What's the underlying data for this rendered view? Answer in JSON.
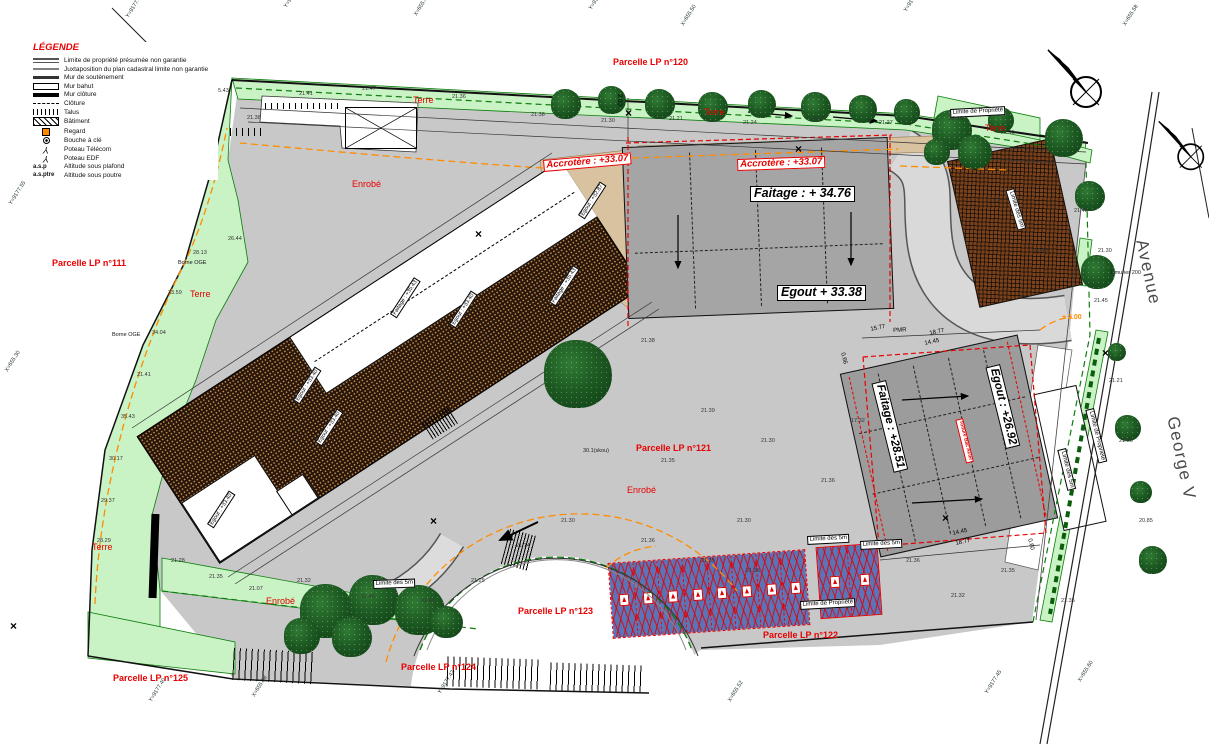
{
  "legend": {
    "title": "LÉGENDE",
    "items": [
      {
        "sym": "lim-prop",
        "label": "Limite de propriété présumée non garantie"
      },
      {
        "sym": "juxta",
        "label": "Juxtaposition du plan cadastral limite non garantie"
      },
      {
        "sym": "mur-sout",
        "label": "Mur de soutènement"
      },
      {
        "sym": "mur-bahut",
        "label": "Mur bahut"
      },
      {
        "sym": "mur-cloture",
        "label": "Mur clôture"
      },
      {
        "sym": "cloture",
        "label": "Clôture"
      },
      {
        "sym": "talus",
        "label": "Talus"
      },
      {
        "sym": "batiment",
        "label": "Bâtiment"
      },
      {
        "sym": "regard",
        "label": "Regard"
      },
      {
        "sym": "bouche",
        "label": "Bouche à clé"
      },
      {
        "sym": "poteau",
        "label": "Poteau Télécom"
      },
      {
        "sym": "poteau",
        "label": "Poteau EDF"
      },
      {
        "key": "a.s.p",
        "label": "Altitude sous plafond"
      },
      {
        "key": "a.s.ptre",
        "label": "Altitude sous poutre"
      }
    ]
  },
  "labels": {
    "parcels": {
      "cls": "parcel",
      "items": [
        {
          "t": "Parcelle LP n°120",
          "x": 613,
          "y": 58
        },
        {
          "t": "Parcelle LP n°111",
          "x": 52,
          "y": 259
        },
        {
          "t": "Parcelle LP n°121",
          "x": 636,
          "y": 444
        },
        {
          "t": "Parcelle LP n°122",
          "x": 763,
          "y": 631
        },
        {
          "t": "Parcelle LP n°123",
          "x": 518,
          "y": 607
        },
        {
          "t": "Parcelle LP n°124",
          "x": 401,
          "y": 663
        },
        {
          "t": "Parcelle LP n°125",
          "x": 113,
          "y": 674
        }
      ]
    },
    "terre": {
      "cls": "terre",
      "items": [
        {
          "t": "Terre",
          "x": 413,
          "y": 96
        },
        {
          "t": "Terre",
          "x": 704,
          "y": 108
        },
        {
          "t": "Terre",
          "x": 985,
          "y": 124
        },
        {
          "t": "Terre",
          "x": 190,
          "y": 290
        },
        {
          "t": "Terre",
          "x": 92,
          "y": 543
        }
      ]
    },
    "enrobe": {
      "cls": "enrobe",
      "items": [
        {
          "t": "Enrobé",
          "x": 352,
          "y": 180
        },
        {
          "t": "Enrobé",
          "x": 627,
          "y": 486
        },
        {
          "t": "Enrobé",
          "x": 266,
          "y": 597
        }
      ]
    },
    "acrotere": {
      "cls": "acro",
      "items": [
        {
          "t": "Accrotère : +33.07",
          "x": 543,
          "y": 160,
          "r": -5
        },
        {
          "t": "Accrotère : +33.07",
          "x": 737,
          "y": 159,
          "r": -2
        }
      ]
    },
    "altitudes": {
      "cls": "alt-big",
      "items": [
        {
          "t": "Faitage  : + 34.76",
          "x": 750,
          "y": 186
        },
        {
          "t": "Egout + 33.38",
          "x": 777,
          "y": 285
        }
      ]
    },
    "altitudes_rot": {
      "cls": "alt-rot",
      "items": [
        {
          "t": "Faitage : +28.51",
          "x": 886,
          "y": 380,
          "r": 76
        },
        {
          "t": "Egout : +26.92",
          "x": 1000,
          "y": 364,
          "r": 76
        }
      ]
    },
    "redrot": {
      "cls": "redrot",
      "items": [
        {
          "t": "Toiture Bac Acier",
          "x": 963,
          "y": 418,
          "r": 76
        }
      ]
    },
    "limites": {
      "cls": "limite",
      "items": [
        {
          "t": "Limite des 5m",
          "x": 807,
          "y": 536,
          "r": -3
        },
        {
          "t": "Limite des 5m",
          "x": 860,
          "y": 541,
          "r": -3
        },
        {
          "t": "Limite de Propriété",
          "x": 800,
          "y": 601,
          "r": -3
        },
        {
          "t": "Limite des 5m",
          "x": 373,
          "y": 580,
          "r": -2
        },
        {
          "t": "Limite de Propriété",
          "x": 950,
          "y": 109,
          "r": -3
        },
        {
          "t": "Limite des 5m",
          "x": 1014,
          "y": 188,
          "r": 73
        },
        {
          "t": "Limite des 5m",
          "x": 1066,
          "y": 448,
          "r": 76
        },
        {
          "t": "Limite de Propriété",
          "x": 1094,
          "y": 408,
          "r": 76
        }
      ]
    },
    "street": {
      "cls": "street",
      "items": [
        {
          "t": "Avenue",
          "x": 1150,
          "y": 238,
          "r": 78
        },
        {
          "t": "George V",
          "x": 1181,
          "y": 415,
          "r": 78
        }
      ]
    },
    "dims": {
      "cls": "dim",
      "items": [
        {
          "t": "PMR",
          "x": 893,
          "y": 328,
          "r": -3
        },
        {
          "t": "15.77",
          "x": 870,
          "y": 327,
          "r": -12
        },
        {
          "t": "18.77",
          "x": 929,
          "y": 331,
          "r": -12
        },
        {
          "t": "14.45",
          "x": 924,
          "y": 341,
          "r": -12
        },
        {
          "t": "14.45",
          "x": 952,
          "y": 531,
          "r": -12
        },
        {
          "t": "18.77",
          "x": 955,
          "y": 541,
          "r": -12
        },
        {
          "t": "2.00",
          "x": 622,
          "y": 94,
          "r": 90
        },
        {
          "t": "0.66",
          "x": 845,
          "y": 352,
          "r": 76
        },
        {
          "t": "0.60",
          "x": 1032,
          "y": 538,
          "r": 76
        }
      ]
    },
    "orangelbl": {
      "cls": "orange",
      "items": [
        {
          "t": "+ 2.00",
          "x": 1062,
          "y": 314
        }
      ]
    },
    "borne": {
      "cls": "borne",
      "items": [
        {
          "t": "Borne OGE",
          "x": 178,
          "y": 260
        },
        {
          "t": "Borne OGE",
          "x": 112,
          "y": 332
        }
      ]
    },
    "rooflbl": {
      "cls": "rooflbl",
      "items": [
        {
          "t": "Egout : +33.40",
          "x": 293,
          "y": 400,
          "r": -57
        },
        {
          "t": "Faitage : +35.43",
          "x": 390,
          "y": 314,
          "r": -57
        },
        {
          "t": "Egout : +33.40",
          "x": 449,
          "y": 324,
          "r": -57
        },
        {
          "t": "Faitage : +35.43",
          "x": 549,
          "y": 302,
          "r": -57
        },
        {
          "t": "Egout : +33.40",
          "x": 315,
          "y": 442,
          "r": -57
        },
        {
          "t": "Egout : +33.40",
          "x": 207,
          "y": 524,
          "r": -57
        },
        {
          "t": "Egout : +32.87",
          "x": 578,
          "y": 215,
          "r": -57
        }
      ]
    },
    "crosses": {
      "cls": "cross",
      "items": [
        {
          "t": "×",
          "x": 200,
          "y": 96
        },
        {
          "t": "×",
          "x": 475,
          "y": 228
        },
        {
          "t": "×",
          "x": 10,
          "y": 620
        },
        {
          "t": "×",
          "x": 795,
          "y": 143
        },
        {
          "t": "×",
          "x": 430,
          "y": 515
        },
        {
          "t": "×",
          "x": 1102,
          "y": 347
        },
        {
          "t": "×",
          "x": 625,
          "y": 107
        },
        {
          "t": "×",
          "x": 942,
          "y": 512
        }
      ]
    },
    "coords": {
      "cls": "coord",
      "items": [
        {
          "t": "Y=9177.66",
          "x": 125,
          "y": 16,
          "r": -58
        },
        {
          "t": "Y=9177.68",
          "x": 283,
          "y": 6,
          "r": -58
        },
        {
          "t": "X=655.42",
          "x": 413,
          "y": 14,
          "r": -58
        },
        {
          "t": "Y=9177.70",
          "x": 588,
          "y": 8,
          "r": -58
        },
        {
          "t": "X=655.50",
          "x": 680,
          "y": 24,
          "r": -58
        },
        {
          "t": "Y=9177.74",
          "x": 903,
          "y": 10,
          "r": -58
        },
        {
          "t": "X=655.58",
          "x": 1122,
          "y": 24,
          "r": -58
        },
        {
          "t": "Y=9177.55",
          "x": 8,
          "y": 203,
          "r": -58
        },
        {
          "t": "X=655.30",
          "x": 4,
          "y": 370,
          "r": -58
        },
        {
          "t": "Y=9177.40",
          "x": 148,
          "y": 700,
          "r": -58
        },
        {
          "t": "X=655.38",
          "x": 251,
          "y": 695,
          "r": -58
        },
        {
          "t": "Y=9177.42",
          "x": 437,
          "y": 692,
          "r": -58
        },
        {
          "t": "X=655.52",
          "x": 727,
          "y": 700,
          "r": -58
        },
        {
          "t": "Y=9177.45",
          "x": 984,
          "y": 692,
          "r": -58
        },
        {
          "t": "X=655.60",
          "x": 1077,
          "y": 680,
          "r": -58
        }
      ]
    },
    "tiny": {
      "cls": "tiny",
      "items": [
        {
          "t": "30.1(skou)",
          "x": 583,
          "y": 448
        },
        {
          "t": "1 murier 200",
          "x": 1110,
          "y": 270
        }
      ]
    },
    "elev": {
      "cls": "elev",
      "items": [
        {
          "t": "21.38",
          "x": 247,
          "y": 115
        },
        {
          "t": "21.41",
          "x": 299,
          "y": 91
        },
        {
          "t": "21.47",
          "x": 362,
          "y": 86
        },
        {
          "t": "21.36",
          "x": 452,
          "y": 94
        },
        {
          "t": "21.38",
          "x": 531,
          "y": 112
        },
        {
          "t": "21.30",
          "x": 601,
          "y": 118
        },
        {
          "t": "21.21",
          "x": 669,
          "y": 116
        },
        {
          "t": "21.24",
          "x": 743,
          "y": 120
        },
        {
          "t": "21.27",
          "x": 813,
          "y": 116
        },
        {
          "t": "21.27",
          "x": 879,
          "y": 120
        },
        {
          "t": "22.10",
          "x": 949,
          "y": 116
        },
        {
          "t": "22.15",
          "x": 1001,
          "y": 130
        },
        {
          "t": "26.44",
          "x": 228,
          "y": 236
        },
        {
          "t": "28.13",
          "x": 193,
          "y": 250
        },
        {
          "t": "33.59",
          "x": 168,
          "y": 290
        },
        {
          "t": "34.04",
          "x": 152,
          "y": 330
        },
        {
          "t": "21.41",
          "x": 137,
          "y": 372
        },
        {
          "t": "35.43",
          "x": 121,
          "y": 414
        },
        {
          "t": "30.17",
          "x": 109,
          "y": 456
        },
        {
          "t": "29.37",
          "x": 101,
          "y": 498
        },
        {
          "t": "28.29",
          "x": 97,
          "y": 538
        },
        {
          "t": "21.28",
          "x": 171,
          "y": 558
        },
        {
          "t": "21.35",
          "x": 209,
          "y": 574
        },
        {
          "t": "21.07",
          "x": 249,
          "y": 586
        },
        {
          "t": "21.32",
          "x": 297,
          "y": 578
        },
        {
          "t": "21.40",
          "x": 361,
          "y": 594
        },
        {
          "t": "21.43",
          "x": 421,
          "y": 598
        },
        {
          "t": "21.25",
          "x": 471,
          "y": 578
        },
        {
          "t": "21.14",
          "x": 516,
          "y": 543
        },
        {
          "t": "21.30",
          "x": 561,
          "y": 518
        },
        {
          "t": "21.36",
          "x": 641,
          "y": 538
        },
        {
          "t": "21.35",
          "x": 701,
          "y": 558
        },
        {
          "t": "21.36",
          "x": 746,
          "y": 568
        },
        {
          "t": "21.35",
          "x": 661,
          "y": 458
        },
        {
          "t": "21.30",
          "x": 737,
          "y": 518
        },
        {
          "t": "21.36",
          "x": 821,
          "y": 478
        },
        {
          "t": "17.32",
          "x": 851,
          "y": 418
        },
        {
          "t": "21.38",
          "x": 641,
          "y": 338
        },
        {
          "t": "21.39",
          "x": 701,
          "y": 408
        },
        {
          "t": "21.30",
          "x": 761,
          "y": 438
        },
        {
          "t": "21.36",
          "x": 906,
          "y": 558
        },
        {
          "t": "21.32",
          "x": 951,
          "y": 593
        },
        {
          "t": "21.35",
          "x": 1001,
          "y": 568
        },
        {
          "t": "21.35",
          "x": 1061,
          "y": 598
        },
        {
          "t": "21.30",
          "x": 1098,
          "y": 248
        },
        {
          "t": "21.45",
          "x": 1094,
          "y": 298
        },
        {
          "t": "21.21",
          "x": 1109,
          "y": 378
        },
        {
          "t": "21.30",
          "x": 1119,
          "y": 438
        },
        {
          "t": "20.85",
          "x": 1139,
          "y": 518
        },
        {
          "t": "21.48",
          "x": 1074,
          "y": 208
        },
        {
          "t": "27.77",
          "x": 989,
          "y": 198
        },
        {
          "t": "21.45",
          "x": 1034,
          "y": 248
        },
        {
          "t": "35.43",
          "x": 215,
          "y": 88
        }
      ]
    }
  }
}
